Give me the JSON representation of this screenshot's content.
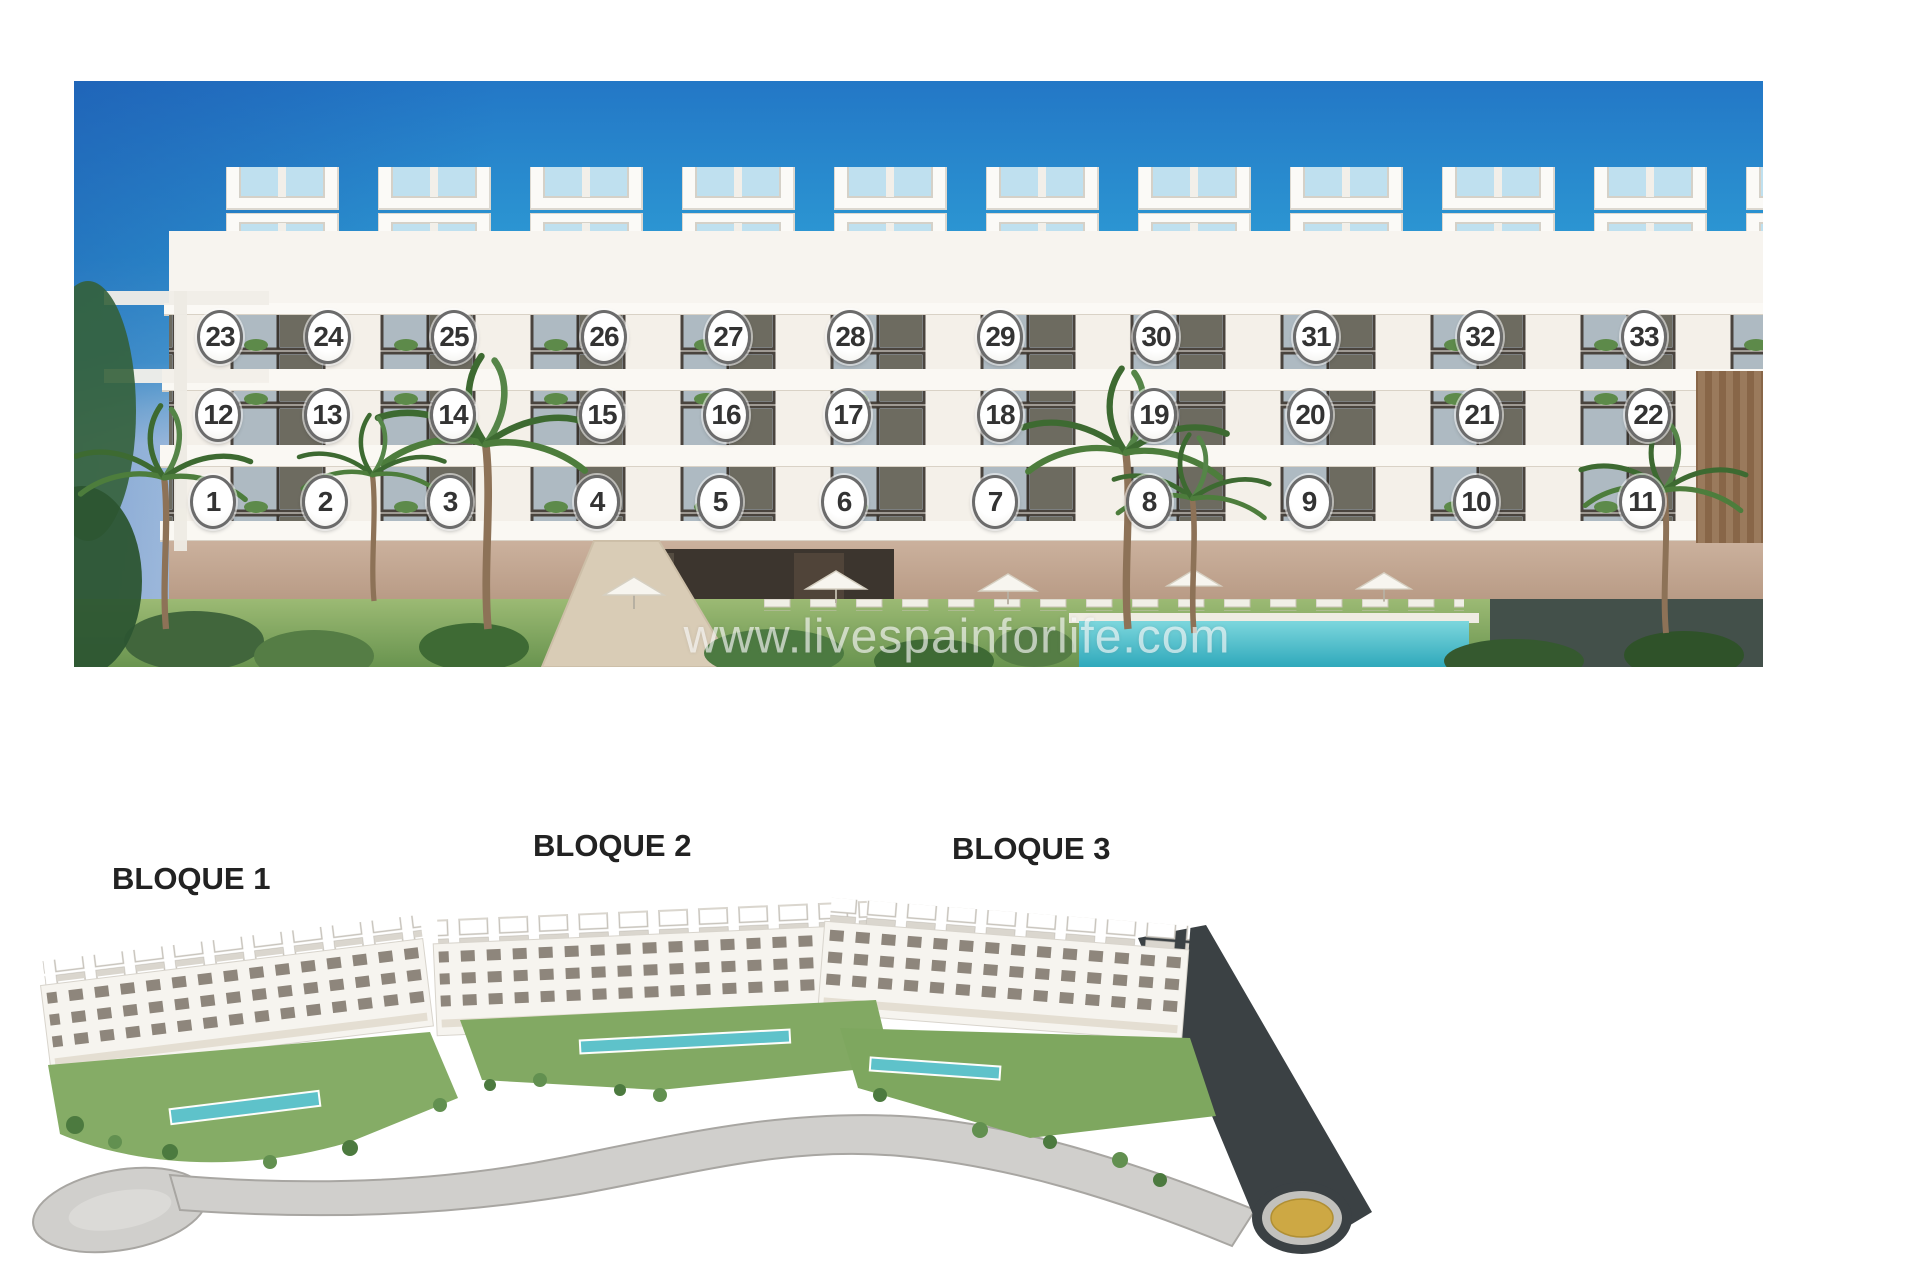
{
  "photo": {
    "watermark": "www.livespainforlife.com",
    "units": [
      {
        "n": "1",
        "x": 139,
        "y": 421
      },
      {
        "n": "2",
        "x": 251,
        "y": 421
      },
      {
        "n": "3",
        "x": 376,
        "y": 421
      },
      {
        "n": "4",
        "x": 523,
        "y": 421
      },
      {
        "n": "5",
        "x": 646,
        "y": 421
      },
      {
        "n": "6",
        "x": 770,
        "y": 421
      },
      {
        "n": "7",
        "x": 921,
        "y": 421
      },
      {
        "n": "8",
        "x": 1075,
        "y": 421
      },
      {
        "n": "9",
        "x": 1235,
        "y": 421
      },
      {
        "n": "10",
        "x": 1402,
        "y": 421
      },
      {
        "n": "11",
        "x": 1568,
        "y": 421
      },
      {
        "n": "12",
        "x": 144,
        "y": 334
      },
      {
        "n": "13",
        "x": 253,
        "y": 334
      },
      {
        "n": "14",
        "x": 379,
        "y": 334
      },
      {
        "n": "15",
        "x": 528,
        "y": 334
      },
      {
        "n": "16",
        "x": 652,
        "y": 334
      },
      {
        "n": "17",
        "x": 774,
        "y": 334
      },
      {
        "n": "18",
        "x": 926,
        "y": 334
      },
      {
        "n": "19",
        "x": 1080,
        "y": 334
      },
      {
        "n": "20",
        "x": 1236,
        "y": 334
      },
      {
        "n": "21",
        "x": 1405,
        "y": 334
      },
      {
        "n": "22",
        "x": 1574,
        "y": 334
      },
      {
        "n": "23",
        "x": 146,
        "y": 256
      },
      {
        "n": "24",
        "x": 254,
        "y": 256
      },
      {
        "n": "25",
        "x": 380,
        "y": 256
      },
      {
        "n": "26",
        "x": 530,
        "y": 256
      },
      {
        "n": "27",
        "x": 654,
        "y": 256
      },
      {
        "n": "28",
        "x": 776,
        "y": 256
      },
      {
        "n": "29",
        "x": 926,
        "y": 256
      },
      {
        "n": "30",
        "x": 1082,
        "y": 256
      },
      {
        "n": "31",
        "x": 1242,
        "y": 256
      },
      {
        "n": "32",
        "x": 1406,
        "y": 256
      },
      {
        "n": "33",
        "x": 1570,
        "y": 256
      }
    ]
  },
  "site_plan": {
    "blocks": [
      {
        "label": "BLOQUE 1"
      },
      {
        "label": "BLOQUE 2"
      },
      {
        "label": "BLOQUE 3"
      }
    ]
  },
  "colors": {
    "sky_top": "#2377c6",
    "sky_mid": "#2d9ad4",
    "sky_horizon": "#d9edf5",
    "building_white": "#f6f3ee",
    "window_dark": "#4d453d",
    "pool_teal": "#54bfca",
    "lawn_green": "#7da65f",
    "road_gray": "#d0cfcc",
    "roundabout_dark": "#3b4144",
    "roundabout_yellow": "#cda844",
    "marker_border": "#6b6b6b",
    "marker_text": "#333333",
    "label_text": "#222222"
  }
}
